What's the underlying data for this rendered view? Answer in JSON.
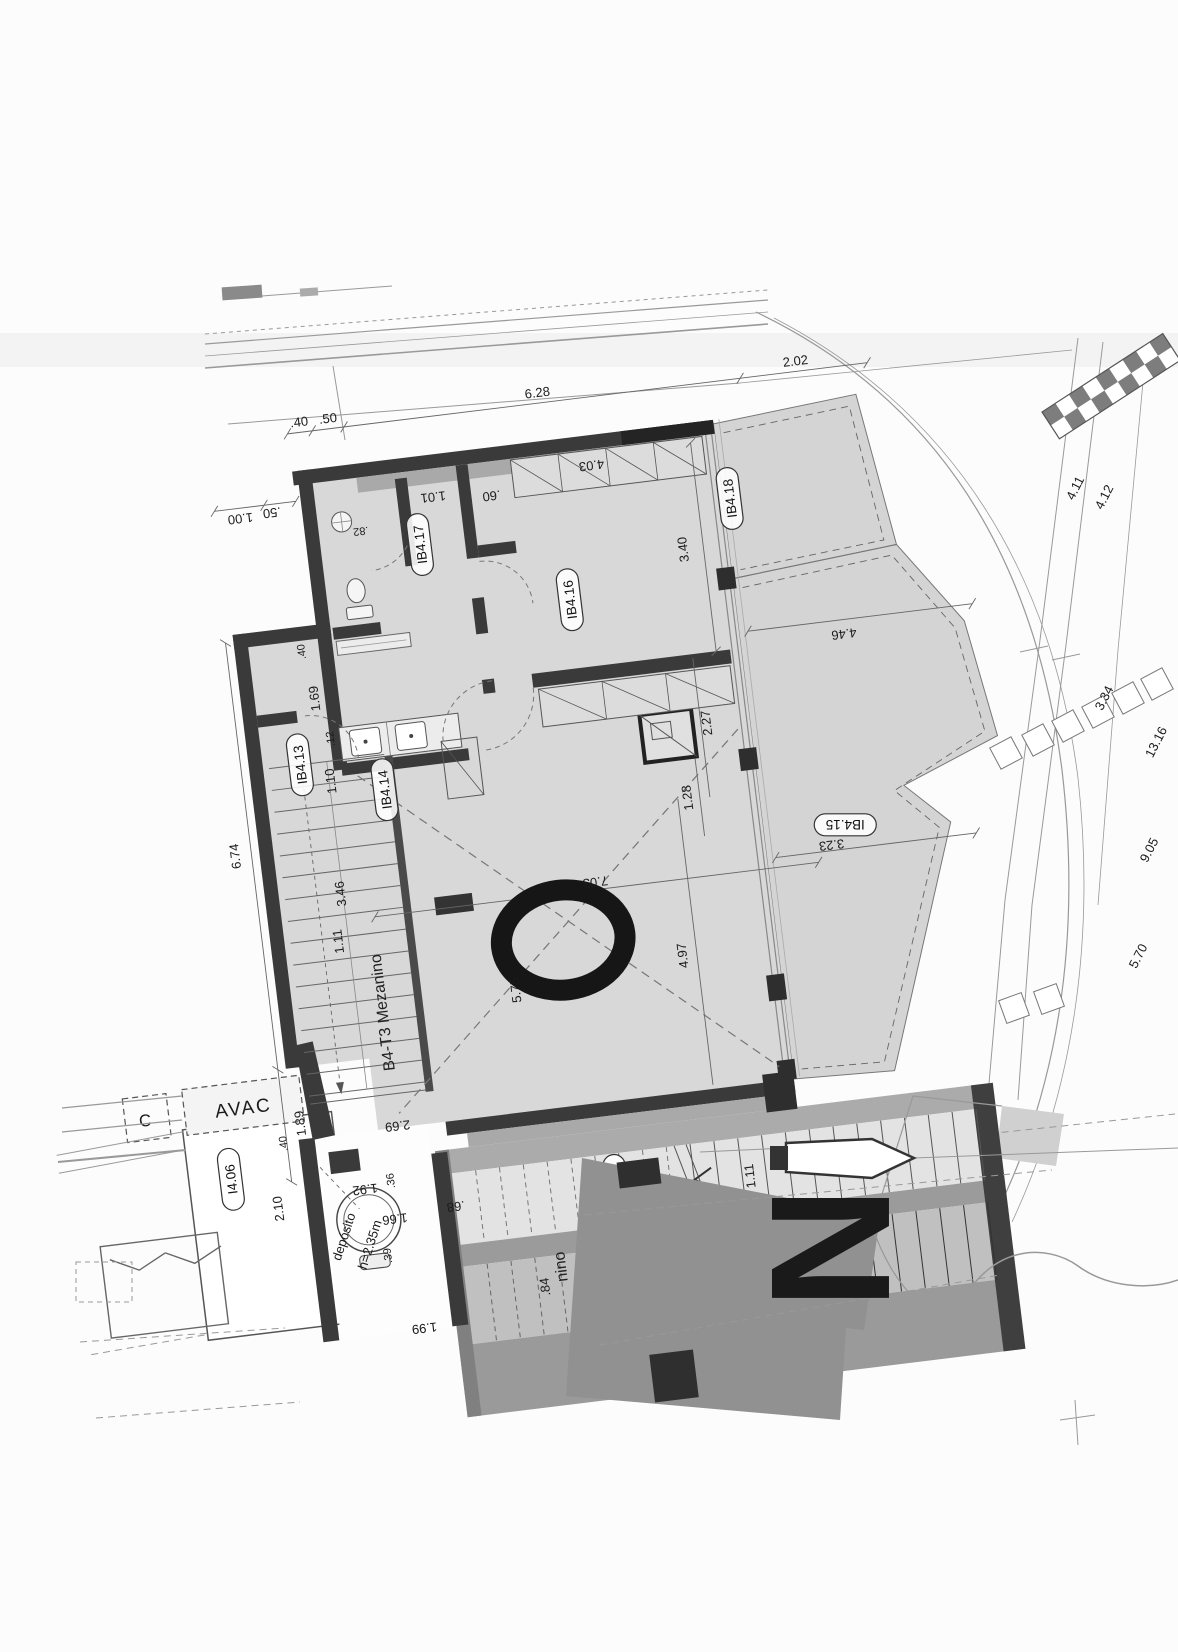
{
  "colors": {
    "wall": "#3a3a3a",
    "floor": "#d8d8d8",
    "terrace": "#d4d4d4",
    "ink": "#1b1b1b"
  },
  "rooms": {
    "ib413": "IB4.13",
    "ib414": "IB4.14",
    "ib415": "IB4.15",
    "ib416": "IB4.16",
    "ib417": "IB4.17",
    "ib418": "IB4.18",
    "ib419": "IB4.19",
    "ia419": "IA4.19",
    "i406": "I4.06"
  },
  "texts": {
    "unit": "B4-T3 Mezanino",
    "unit_partial": "nino",
    "avac": "AVAC",
    "avac_partial": "C",
    "deposito": "depósito",
    "deposito_height": "h=2.35m",
    "void_marker": "O",
    "north": "N"
  },
  "dims": {
    "top_040": ".40",
    "top_050": ".50",
    "top_628": "6.28",
    "top_202": "2.02",
    "left_100": "1.00",
    "left_050": ".50",
    "left_674": "6.74",
    "left_189": "1.89",
    "bath_082": ".82",
    "hall_101": "1.01",
    "closet_060": ".60",
    "bed_403": "4.03",
    "bed_340": "3.40",
    "bed_227": "2.27",
    "bed_128": "1.28",
    "wing_040": ".40",
    "wing_169": "1.69",
    "stair_012": ".12",
    "stair_110": "1.10",
    "stair_346": "3.46",
    "stair_111": "1.11",
    "liv_703": "7.03",
    "liv_575": "5.75",
    "liv_497": "4.97",
    "ter_446": "4.46",
    "ter_323": "3.23",
    "bot_269": "2.69",
    "bot_040": ".40",
    "bot_210": "2.10",
    "bot_036": ".36",
    "bot_192": "1.92",
    "bot_166": "1.66",
    "bot_039": ".39",
    "bot_068": ".68",
    "bot_084": ".84",
    "bot_199": "1.99",
    "run_111a": "1.11",
    "run_029": ".29",
    "run_111b": "1.11",
    "site_411": "4.11",
    "site_412": "4.12",
    "site_334": "3.34",
    "site_1316": "13.16",
    "site_905": "9.05",
    "site_570": "5.70"
  }
}
